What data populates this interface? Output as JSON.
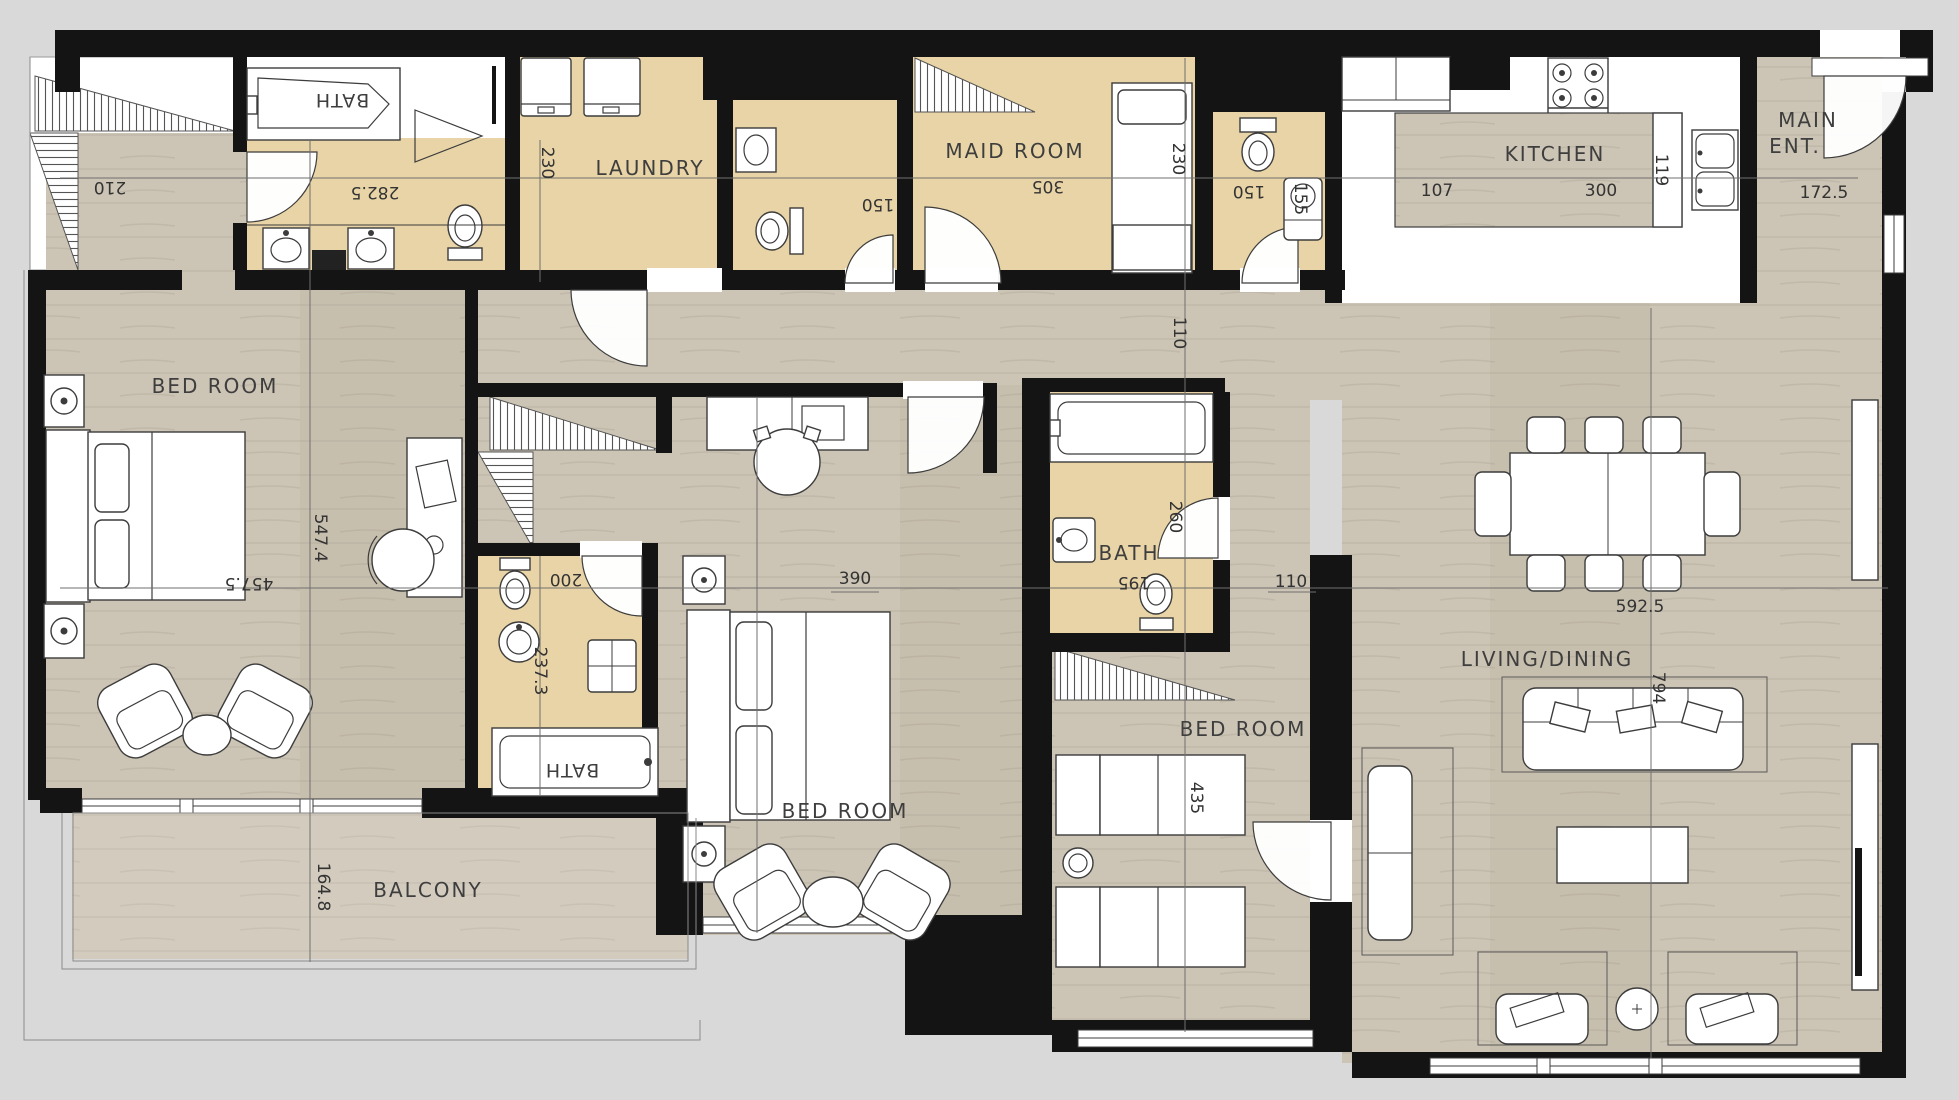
{
  "drawing": {
    "type": "apartment floor plan",
    "colors": {
      "background": "#d9d9d9",
      "wall": "#141414",
      "wood_floor": "#ccc4b4",
      "tan_floor": "#e8d4a6",
      "white_floor": "#ffffff",
      "label_text": "#3e3e3e",
      "dimension_text": "#333333"
    }
  },
  "rooms": {
    "bath_ensuite": {
      "label": "BATH"
    },
    "laundry": {
      "label": "LAUNDRY"
    },
    "maid": {
      "label": "MAID ROOM"
    },
    "kitchen": {
      "label": "KITCHEN"
    },
    "main_ent_line1": {
      "label": "MAIN"
    },
    "main_ent_line2": {
      "label": "ENT."
    },
    "bedroom_left": {
      "label": "BED ROOM"
    },
    "bedroom_middle": {
      "label": "BED ROOM"
    },
    "bedroom_right": {
      "label": "BED ROOM"
    },
    "bath_middle": {
      "label": "BATH"
    },
    "bath_center": {
      "label": "BATH"
    },
    "living": {
      "label": "LIVING/DINING"
    },
    "balcony": {
      "label": "BALCONY"
    }
  },
  "dims": {
    "stairs": {
      "value": "210"
    },
    "ensuite_width": {
      "value": "282.5"
    },
    "laundry_depth": {
      "value": "230"
    },
    "wc1_width": {
      "value": "150"
    },
    "maid_width": {
      "value": "305"
    },
    "maid_depth": {
      "value": "230"
    },
    "wc2_width": {
      "value": "150"
    },
    "wc2_depth": {
      "value": "155"
    },
    "kitchen_a": {
      "value": "107"
    },
    "kitchen_b": {
      "value": "300"
    },
    "kitchen_c": {
      "value": "119"
    },
    "entry": {
      "value": "172.5"
    },
    "corridor": {
      "value": "110"
    },
    "bedl_h": {
      "value": "547.4"
    },
    "bedl_w": {
      "value": "457.5"
    },
    "bedm_w": {
      "value": "390"
    },
    "bathm_a": {
      "value": "200"
    },
    "bathm_b": {
      "value": "237.3"
    },
    "bathc_a": {
      "value": "260"
    },
    "bathc_b": {
      "value": "195"
    },
    "hall": {
      "value": "110"
    },
    "living_w": {
      "value": "592.5"
    },
    "living_h": {
      "value": "794"
    },
    "bedr": {
      "value": "435"
    },
    "balcony_d": {
      "value": "164.8"
    }
  }
}
